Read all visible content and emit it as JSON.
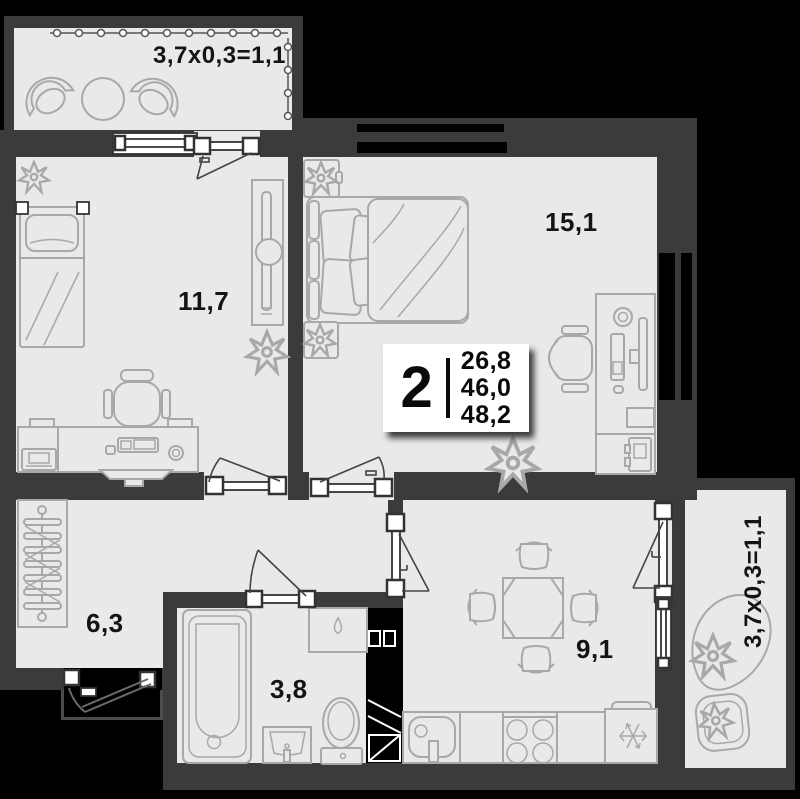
{
  "colors": {
    "background": "#000000",
    "wall": "#3b3b3b",
    "floor": "#e9e9e9",
    "furniture_stroke": "#a8a8a8",
    "text": "#141414",
    "info_box_bg": "#ffffff"
  },
  "info_box": {
    "rooms_count": "2",
    "areas": [
      "26,8",
      "46,0",
      "48,2"
    ]
  },
  "labels": {
    "balcony_top": "3,7x0,3=1,1",
    "bedroom_left": "11,7",
    "bedroom_right": "15,1",
    "hallway": "6,3",
    "bathroom": "3,8",
    "kitchen": "9,1",
    "balcony_right": "3,7x0,3=1,1"
  }
}
